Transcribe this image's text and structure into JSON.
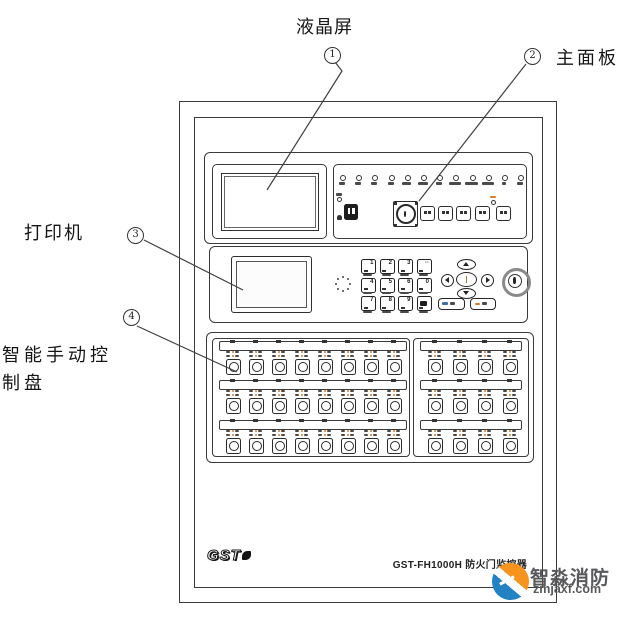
{
  "figure": {
    "annotations": {
      "lcd": {
        "num": "1",
        "label": "液晶屏"
      },
      "main_panel": {
        "num": "2",
        "label": "主面板"
      },
      "printer": {
        "num": "3",
        "label": "打印机"
      },
      "manual_panel": {
        "num": "4",
        "label_line1": "智能手动控",
        "label_line2": "制盘"
      }
    }
  },
  "device": {
    "brand_logo": "GST",
    "model_label": "GST-FH1000H 防火门监控器",
    "main_panel": {
      "indicator_count": 12,
      "function_button_count": 5
    },
    "keypad_keys": [
      [
        "1",
        "2",
        "3",
        "··"
      ],
      [
        "4",
        "5",
        "6",
        "0"
      ],
      [
        "7",
        "8",
        "9",
        "◀"
      ]
    ],
    "control_panel": {
      "rows": 3,
      "left_columns": 8,
      "right_columns": 4
    }
  },
  "watermark": {
    "name": "智淼消防",
    "domain": "zmjaxf.com"
  },
  "colors": {
    "line": "#3a3a3a",
    "led_accent": "#d97b2a",
    "wm_orange": "#f7941e",
    "wm_blue": "#2382c4"
  }
}
